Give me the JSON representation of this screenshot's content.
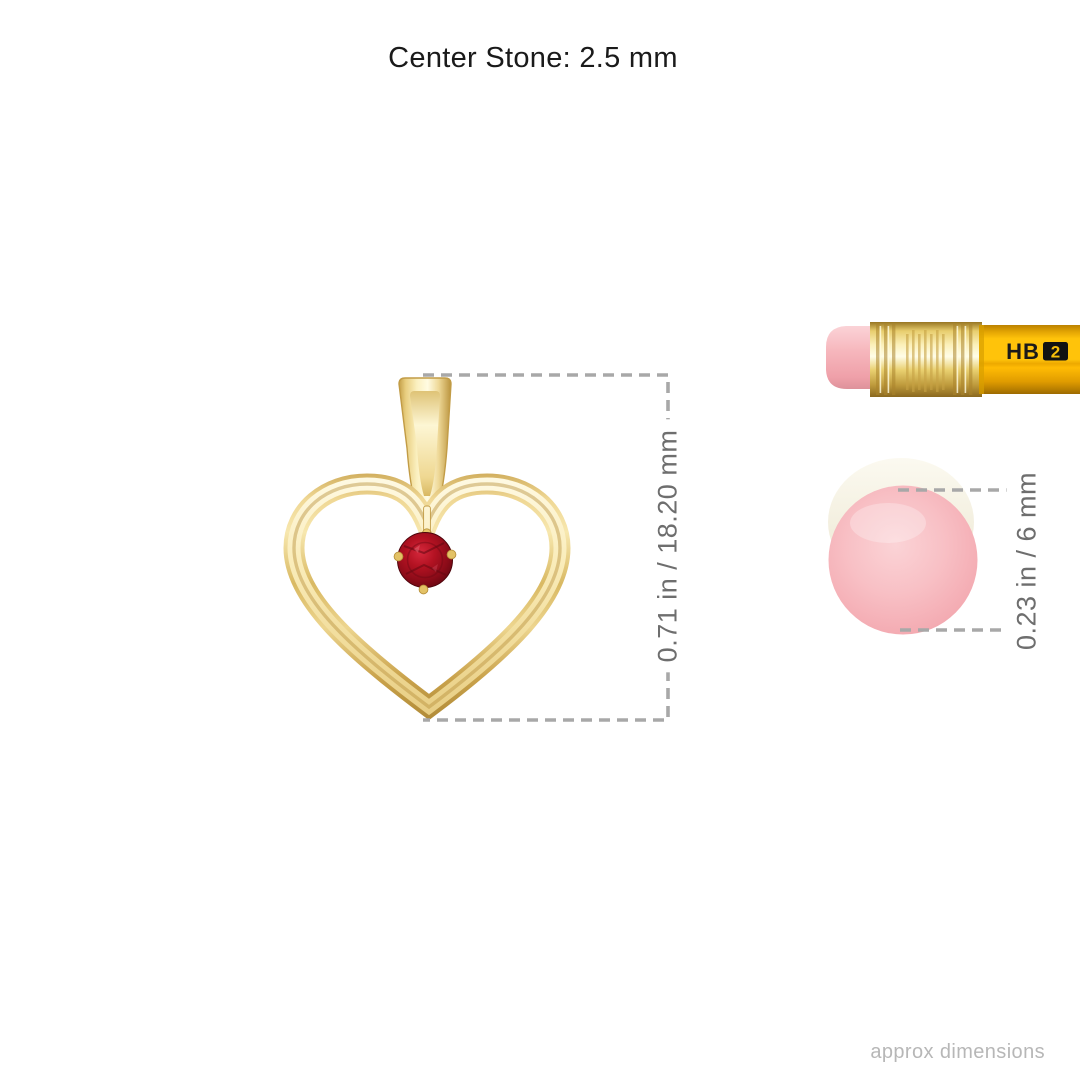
{
  "title": "Center Stone: 2.5 mm",
  "pendant": {
    "dimension_label": "0.71 in / 18.20 mm"
  },
  "pencil": {
    "grade": "HB",
    "number": "2"
  },
  "eraser": {
    "dimension_label": "0.23 in / 6 mm"
  },
  "footer": {
    "note": "approx dimensions"
  },
  "colors": {
    "gold": "#E3C175",
    "gold_highlight": "#FBF0C0",
    "ruby": "#9B0E1D",
    "eraser_pink": "#F7B9BE",
    "pencil_yellow": "#FFC30A",
    "ferrule_gold": "#E8CE6E",
    "dimension_line": "#A8A8A8",
    "dimension_text": "#6E6E6E",
    "title_text": "#1A1A1A",
    "footer_text": "#B7B7B7"
  }
}
